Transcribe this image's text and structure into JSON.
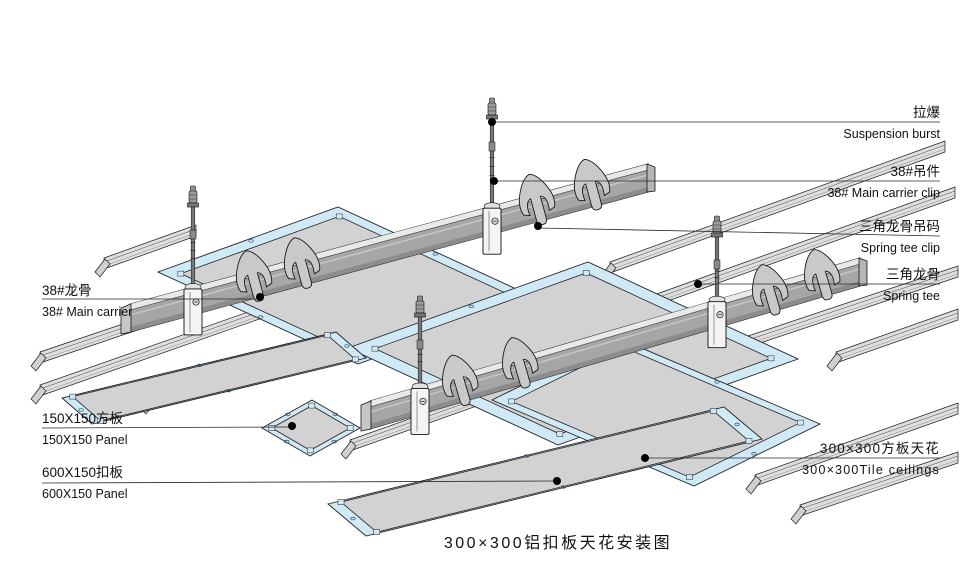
{
  "title": "300×300铝扣板天花安装图",
  "labels": {
    "right": [
      {
        "zh": "拉爆",
        "en": "Suspension burst"
      },
      {
        "zh": "38#吊件",
        "en": "38# Main carrier clip"
      },
      {
        "zh": "三角龙骨吊码",
        "en": "Spring tee clip"
      },
      {
        "zh": "三角龙骨",
        "en": "Spring tee"
      },
      {
        "zh": "300×300方板天花",
        "en": "300×300Tile ceilings"
      }
    ],
    "left": [
      {
        "zh": "38#龙骨",
        "en": "38# Main carrier"
      },
      {
        "zh": "150X150方板",
        "en": "150X150 Panel"
      },
      {
        "zh": "600X150扣板",
        "en": "600X150 Panel"
      }
    ]
  },
  "colors": {
    "background": "#ffffff",
    "line": "#1a1a1a",
    "leader": "#2a2a2a",
    "panel_frame": "#cfe9f7",
    "panel_face": "#d2d2d2",
    "panel_mark": "#35586e",
    "carrier_web": "#a6a6a6",
    "carrier_flange": "#e9e9e9",
    "carrier_shadow": "#8c8c8c",
    "carrier_cap": "#c6c6c6",
    "tee_fill": "#dedede",
    "tee_cap": "#d0d0d0",
    "hook_fill": "#c9c9c9",
    "clip_fill": "#f4f4f4",
    "rod_fill": "#787878",
    "anchor_fill": "#909090",
    "washer_fill": "#e0e0e0"
  }
}
